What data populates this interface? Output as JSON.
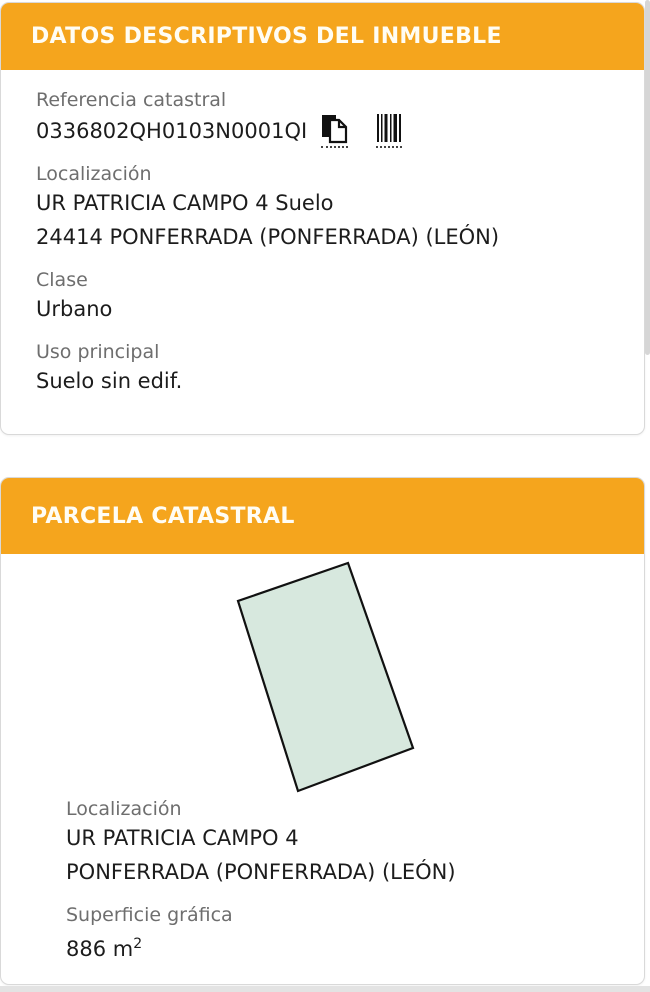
{
  "colors": {
    "accent_orange": "#f5a51d",
    "header_text": "#fffdf4",
    "label_gray": "#6e6e6e",
    "value_black": "#1c1c1c",
    "parcel_fill": "#d7e8de",
    "parcel_stroke": "#111111"
  },
  "card_inmueble": {
    "title": "DATOS DESCRIPTIVOS DEL INMUEBLE",
    "referencia": {
      "label": "Referencia catastral",
      "value": "0336802QH0103N0001QI",
      "copy_icon": "copy-documents-icon",
      "barcode_icon": "barcode-icon"
    },
    "localizacion": {
      "label": "Localización",
      "line1": "UR PATRICIA CAMPO 4 Suelo",
      "line2": "24414 PONFERRADA (PONFERRADA) (LEÓN)"
    },
    "clase": {
      "label": "Clase",
      "value": "Urbano"
    },
    "uso": {
      "label": "Uso principal",
      "value": "Suelo sin edif."
    }
  },
  "card_parcela": {
    "title": "PARCELA CATASTRAL",
    "polygon_points": "347,9 412,194 297,237 237,47",
    "localizacion": {
      "label": "Localización",
      "line1": "UR PATRICIA CAMPO 4",
      "line2": "PONFERRADA (PONFERRADA) (LEÓN)"
    },
    "superficie": {
      "label": "Superficie gráfica",
      "value": "886 m",
      "sup": "2"
    }
  }
}
